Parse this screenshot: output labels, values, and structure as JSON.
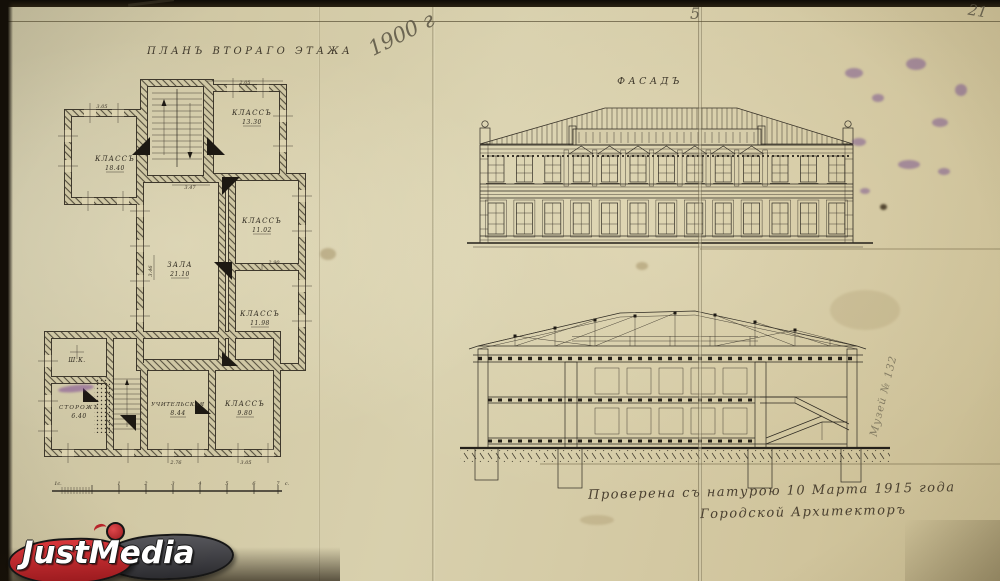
{
  "page": {
    "year_note": "1900 г",
    "sheet_note": "5",
    "page_number": "21",
    "side_note": "Музей № 132"
  },
  "plan": {
    "title": "ПЛАНЪ ВТОРАГО ЭТАЖА",
    "rooms": {
      "class_nw": {
        "name": "КЛАССЪ",
        "area": "18.40"
      },
      "class_ne": {
        "name": "КЛАССЪ",
        "area": "13.30"
      },
      "hall": {
        "name": "ЗАЛА",
        "area": "21.10"
      },
      "class_e1": {
        "name": "КЛАССЪ",
        "area": "11.02"
      },
      "class_e2": {
        "name": "КЛАССЪ",
        "area": "11.98"
      },
      "teachers": {
        "name": "УЧИТЕЛЬСКАЯ",
        "area": "8.44"
      },
      "class_s": {
        "name": "КЛАССЪ",
        "area": "9.80"
      },
      "keeper": {
        "name": "СТОРОЖЪ",
        "area": "6.40"
      },
      "closet": {
        "name": "Ш.К."
      }
    },
    "dims": {
      "d1": "3.05",
      "d2": "2.05",
      "d3": "3.47",
      "d4": "2.90",
      "d5": "3.46",
      "d6": "2.76",
      "d7": "3.05"
    },
    "scale": {
      "left": "1с.",
      "ticks": [
        "1",
        "2",
        "3",
        "4",
        "5",
        "6",
        "7"
      ],
      "unit": "с."
    }
  },
  "facade": {
    "title": "ФАСАДЪ"
  },
  "inscription": {
    "line1": "Проверена съ натурою 10 Марта 1915 года",
    "line2": "Городской Архитекторъ"
  },
  "watermark": {
    "part1": "Just",
    "part2": "Media"
  },
  "colors": {
    "paper": "#d5cca8",
    "ink": "#2e2a22",
    "brand_red": "#c8232b",
    "brand_dark": "#3c3c3e",
    "stain_purple": "#683e8c"
  }
}
